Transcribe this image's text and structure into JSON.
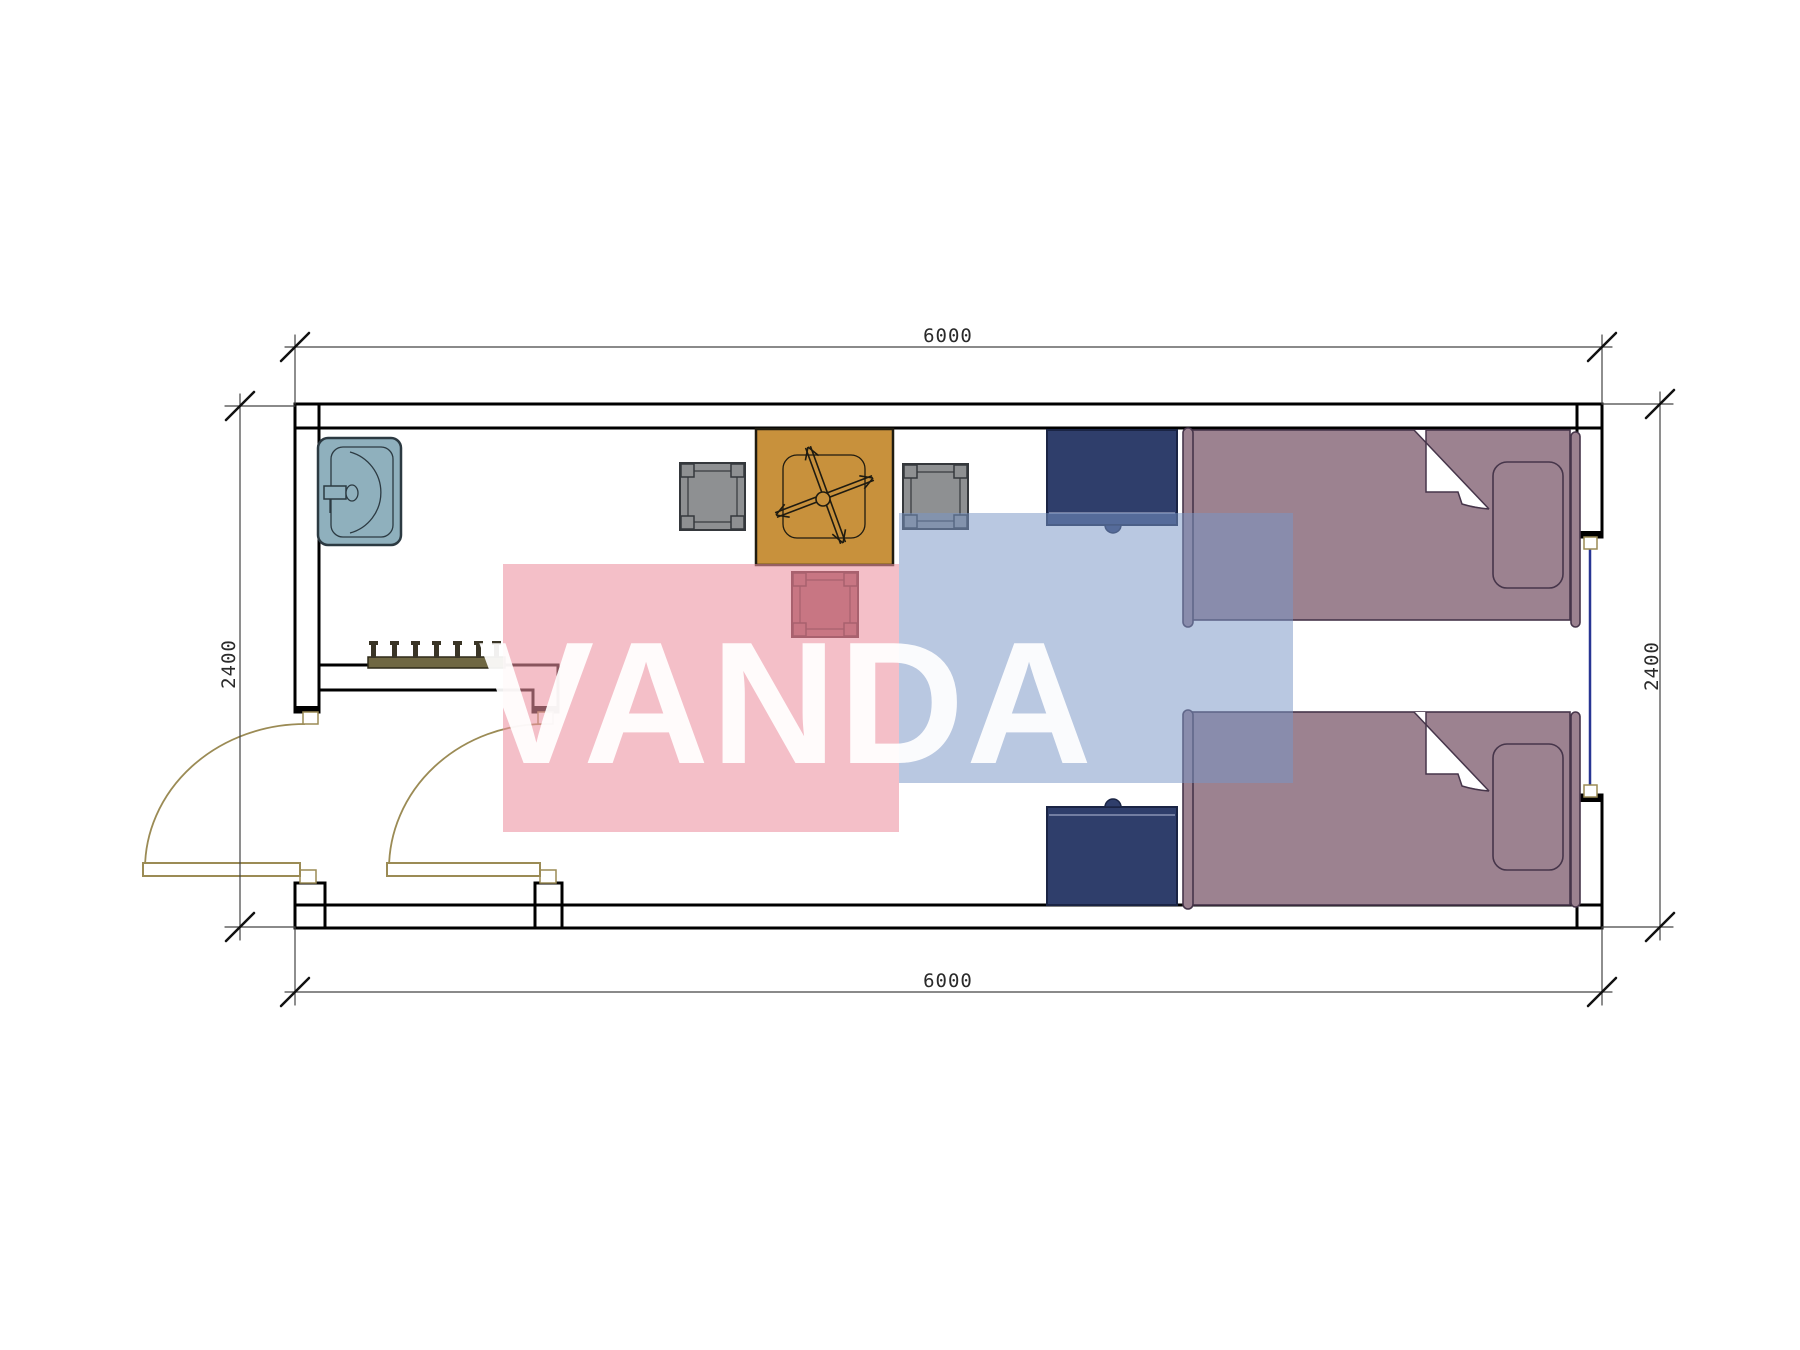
{
  "dimensions": {
    "top": "6000",
    "bottom": "6000",
    "left": "2400",
    "right": "2400"
  },
  "watermark": {
    "text": "VANDA",
    "pink_color": "#f4bec8",
    "blue_color": "#b9c8e1"
  },
  "plan": {
    "elements": [
      "exterior-walls-hatched",
      "interior-partition-wall",
      "entry-door-swing-left",
      "vestibule-door-swing",
      "window-opening-right-wall",
      "washbasin",
      "coat-hook-rail",
      "square-table-fan-base",
      "gray-stool-left",
      "gray-stool-right",
      "red-stool",
      "nightstand-top",
      "nightstand-bottom",
      "single-bed-top",
      "single-bed-bottom"
    ],
    "colors": {
      "wall_hatch": "#a59354",
      "wall_fill": "#f8f4e6",
      "sink": "#8fb0bd",
      "table": "#c8913c",
      "stool_gray": "#8e9092",
      "stool_red": "#96525c",
      "nightstand": "#2f3e6b",
      "bed": "#9c8290",
      "window_line": "#283593",
      "door_swing": "#9b8b55",
      "dimension_text": "#2a2a2a"
    }
  }
}
